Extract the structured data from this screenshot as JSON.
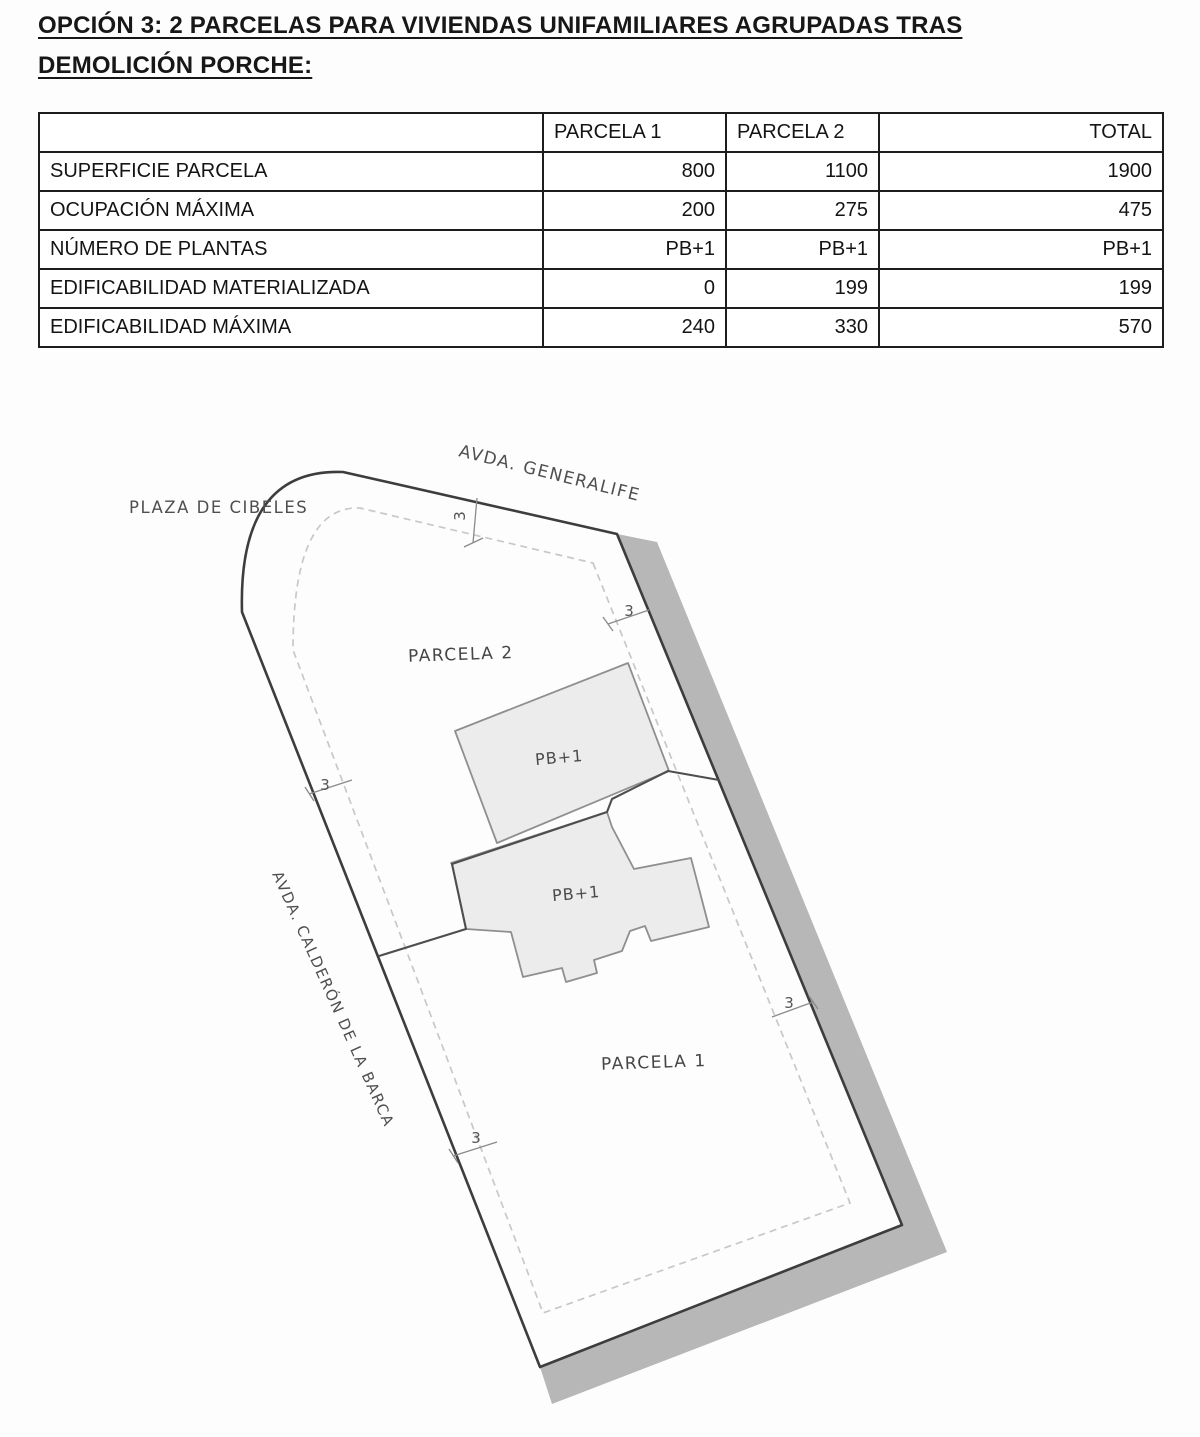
{
  "title": {
    "line1": "OPCIÓN 3: 2 PARCELAS PARA VIVIENDAS UNIFAMILIARES AGRUPADAS TRAS",
    "line2": "DEMOLICIÓN PORCHE:"
  },
  "table": {
    "headers": [
      "",
      "PARCELA 1",
      "PARCELA 2",
      "TOTAL"
    ],
    "rows": [
      {
        "label": "SUPERFICIE PARCELA",
        "parcela1": "800",
        "parcela2": "1100",
        "total": "1900"
      },
      {
        "label": "OCUPACIÓN MÁXIMA",
        "parcela1": "200",
        "parcela2": "275",
        "total": "475"
      },
      {
        "label": "NÚMERO DE PLANTAS",
        "parcela1": "PB+1",
        "parcela2": "PB+1",
        "total": "PB+1"
      },
      {
        "label": "EDIFICABILIDAD MATERIALIZADA",
        "parcela1": "0",
        "parcela2": "199",
        "total": "199"
      },
      {
        "label": "EDIFICABILIDAD MÁXIMA",
        "parcela1": "240",
        "parcela2": "330",
        "total": "570"
      }
    ]
  },
  "plan": {
    "streets": {
      "generalife": "AVDA. GENERALIFE",
      "cibeles": "PLAZA DE CIBELES",
      "calderon": "AVDA. CALDERÓN DE LA BARCA"
    },
    "parcels": {
      "parcela2": "PARCELA 2",
      "parcela1": "PARCELA 1"
    },
    "buildings": {
      "upper": "PB+1",
      "lower": "PB+1"
    },
    "dimensions": {
      "top": "3",
      "right_top": "3",
      "left_top": "3",
      "left_bottom": "3",
      "right_bottom": "3"
    },
    "colors": {
      "band": "#b7b7b7",
      "boundary": "#3d3d3d",
      "setback_dash": "#c8c8c8",
      "building_fill": "#ececec",
      "building_stroke": "#8f8f8f",
      "division": "#4e4e4e"
    }
  }
}
